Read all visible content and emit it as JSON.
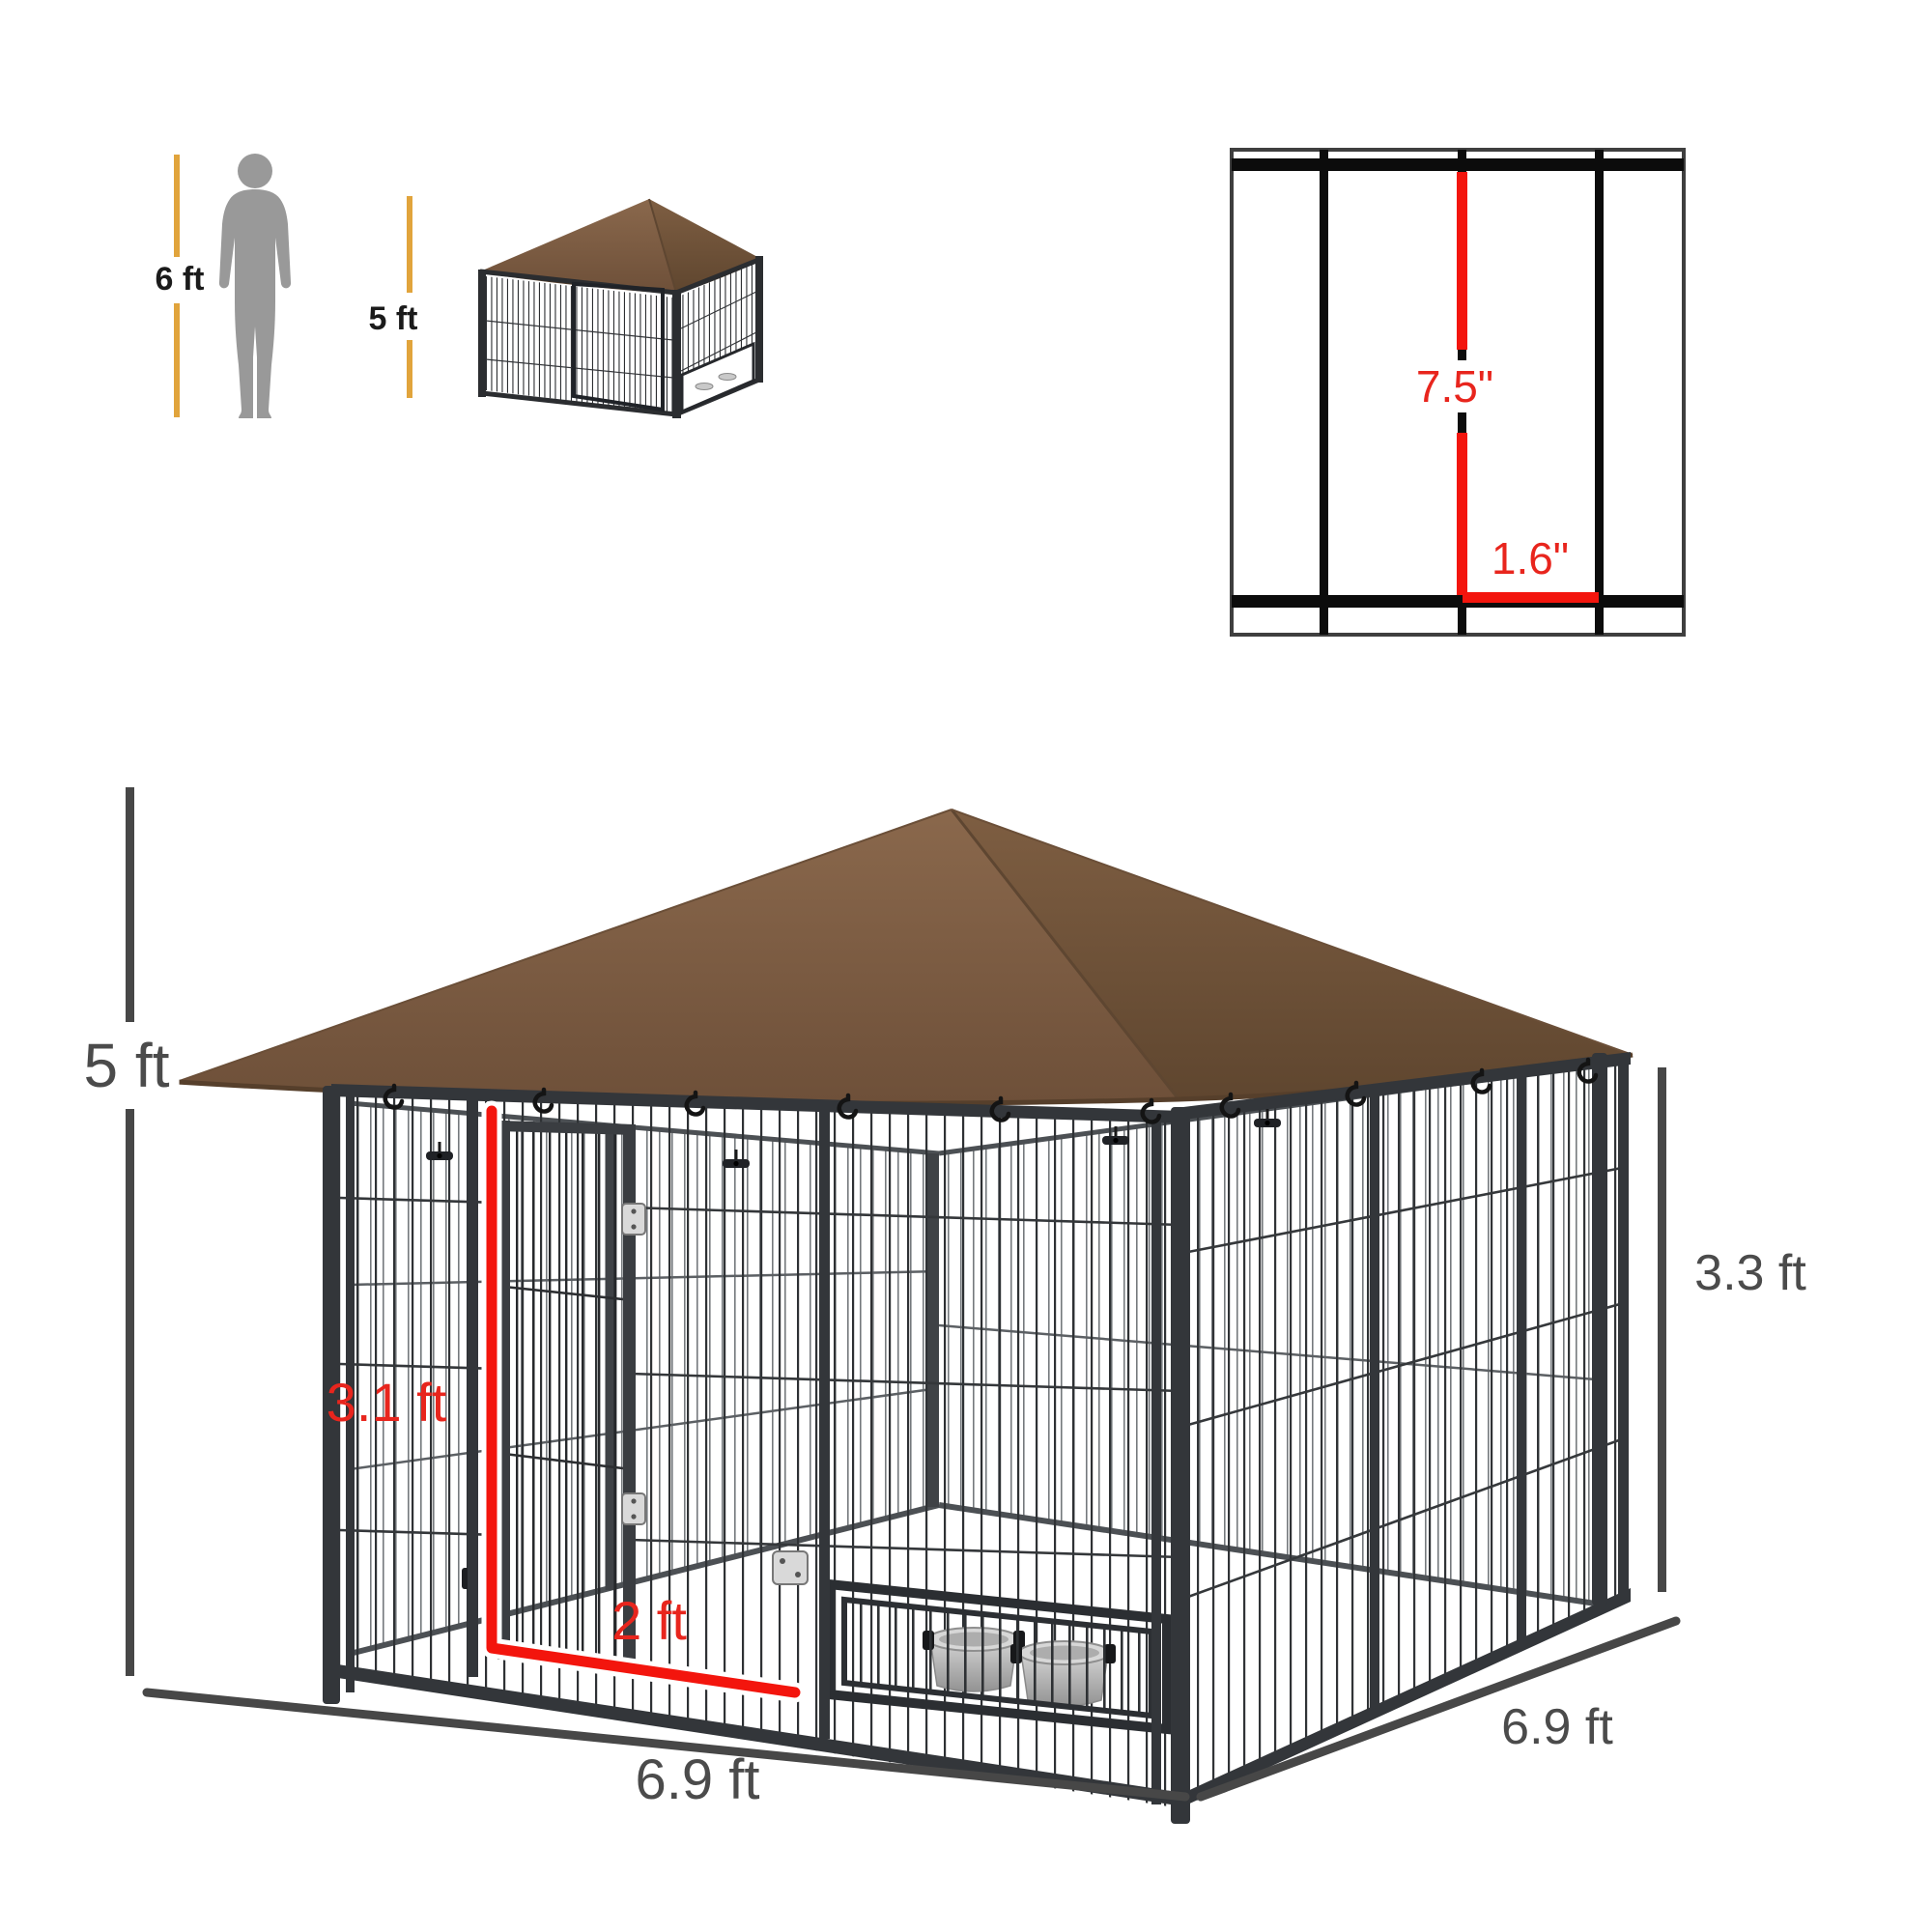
{
  "figure": {
    "type": "product-dimension-diagram",
    "product": "outdoor dog kennel with brown canopy roof, wire mesh walls, door and feeding bowls"
  },
  "scale_reference": {
    "person_height": "6 ft",
    "kennel_height": "5 ft"
  },
  "wire_detail": {
    "vertical_spacing": "7.5\"",
    "horizontal_spacing": "1.6\""
  },
  "dimensions": {
    "overall_height": "5 ft",
    "door_height": "3.1 ft",
    "door_width": "2 ft",
    "front_width": "6.9 ft",
    "side_depth": "6.9 ft",
    "side_panel_height": "3.3 ft"
  },
  "colors": {
    "canopy_brown": "#7d5d42",
    "frame_black": "#2e3134",
    "dimension_gray": "#474747",
    "dimension_yellow": "#e1a43c",
    "annotation_red": "#f3150d",
    "silhouette_gray": "#999999"
  }
}
